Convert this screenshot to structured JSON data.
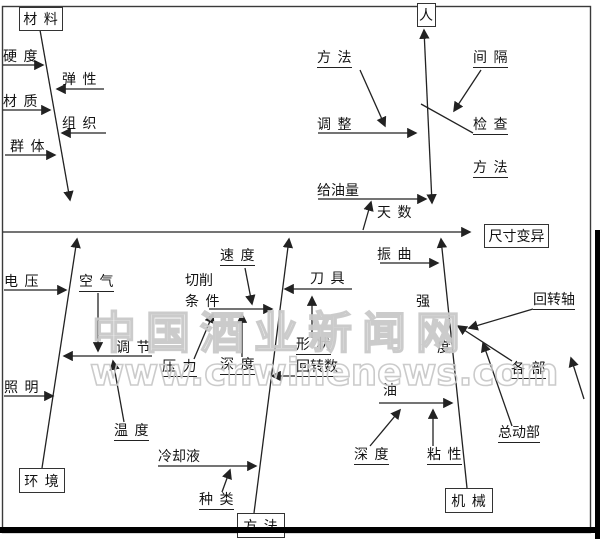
{
  "boxes": {
    "materials": "材 料",
    "person": "人",
    "effect": "尺寸变异",
    "environment": "环 境",
    "method": "方 法",
    "machine": "机 械"
  },
  "causes": {
    "hardness": "硬 度",
    "elasticity": "弹 性",
    "texture": "材 质",
    "structure": "组 织",
    "group": "群 体",
    "method1": "方 法",
    "interval": "间 隔",
    "adjust": "调 整",
    "inspect": "检 查",
    "method2": "方 法",
    "oil_supply": "给油量",
    "days": "天 数",
    "voltage": "电 压",
    "air": "空 气",
    "regulate": "调 节",
    "temperature": "温 度",
    "lighting": "照 明",
    "speed": "速 度",
    "cutting": "切削",
    "condition": "条 件",
    "pressure": "压 力",
    "depth1": "深 度",
    "tool": "刀 具",
    "shape": "形 状",
    "rotation_count": "回转数",
    "coolant": "冷却液",
    "type": "种 类",
    "vibration": "振 曲",
    "strength_top": "强",
    "strength_bottom": "度",
    "rotary_shaft": "回转轴",
    "each_part": "各 部",
    "moving_parts": "总动部",
    "oil": "油",
    "depth2": "深 度",
    "viscosity": "粘 性"
  },
  "watermark": {
    "line1": "中国酒业新闻网",
    "line2": "www.cnwinenews.com"
  },
  "colors": {
    "line": "#222222",
    "frame": "#3a3a3a",
    "text": "#111111",
    "watermark": "#c9c9c9",
    "background": "#ffffff"
  }
}
